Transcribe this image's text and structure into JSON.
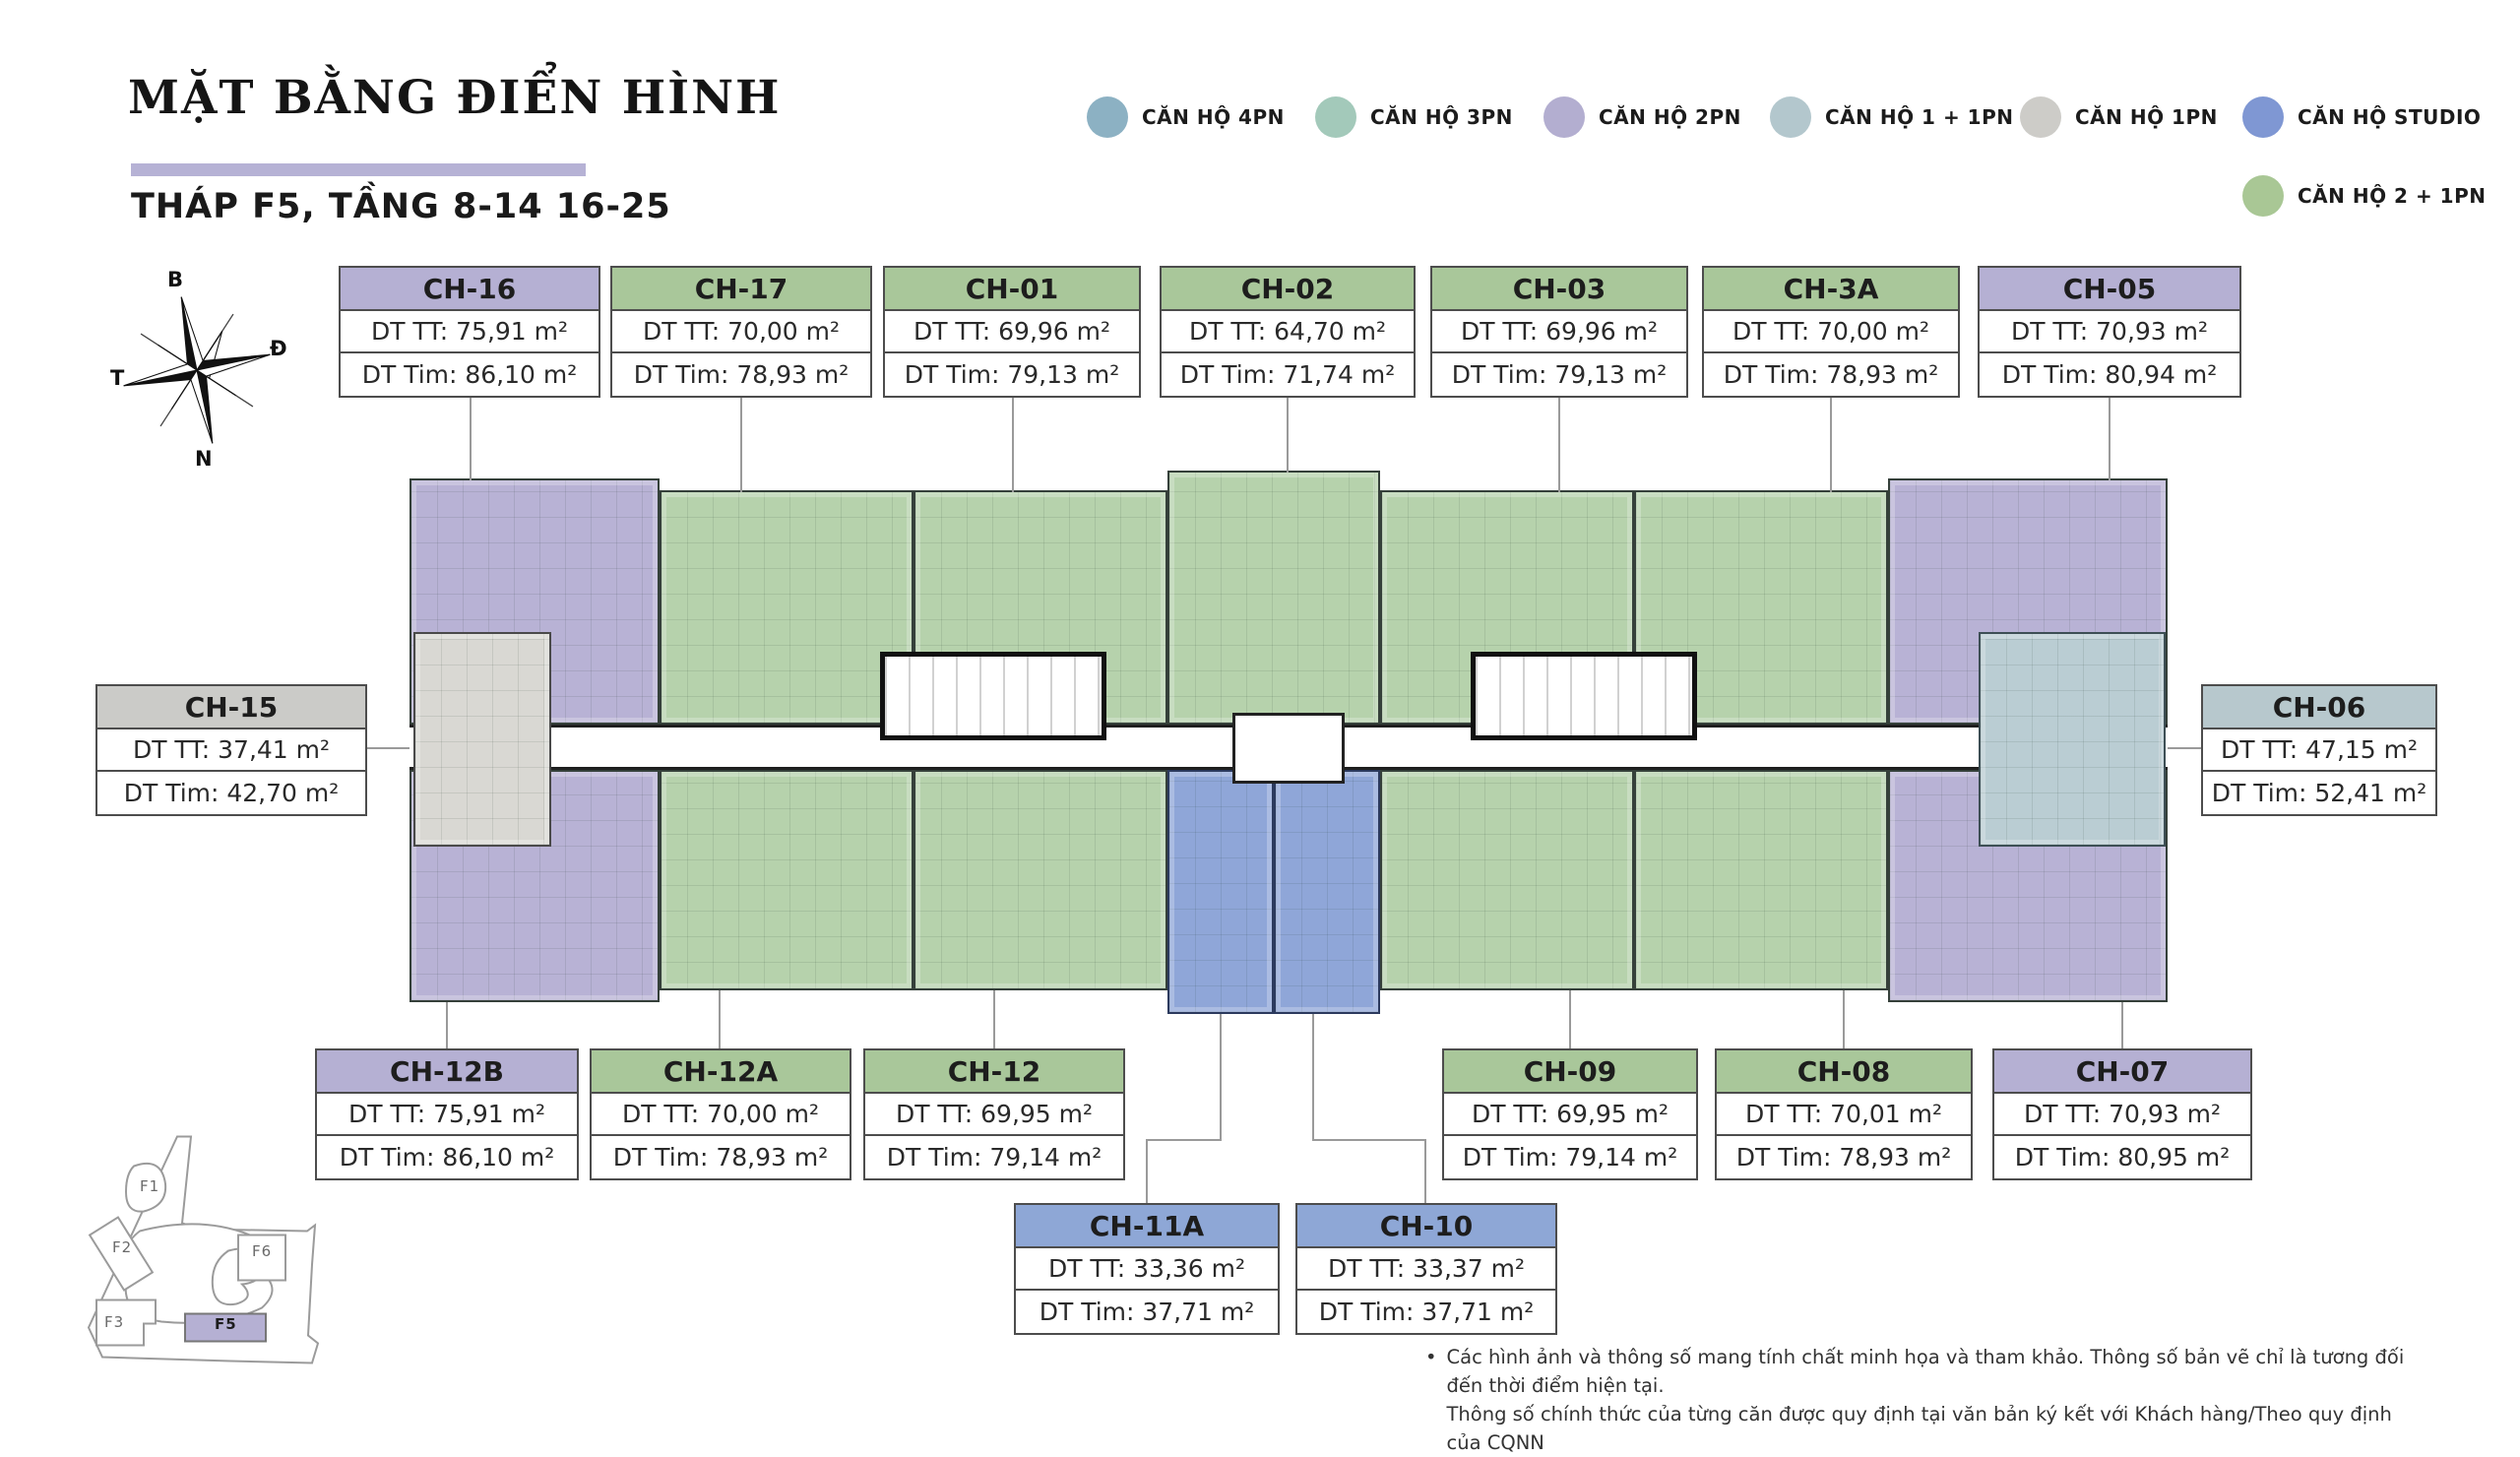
{
  "header": {
    "title": "MẶT BẰNG ĐIỂN HÌNH",
    "subtitle": "THÁP F5, TẦNG 8-14 16-25",
    "accent_bar_color": "#b6b2d5"
  },
  "legend": {
    "items": [
      {
        "label": "CĂN HỘ 4PN",
        "color": "#8cb1c3"
      },
      {
        "label": "CĂN HỘ 3PN",
        "color": "#a3c9ba"
      },
      {
        "label": "CĂN HỘ 2PN",
        "color": "#b3aed0"
      },
      {
        "label": "CĂN HỘ 1 + 1PN",
        "color": "#b3c7cd"
      },
      {
        "label": "CĂN HỘ 1PN",
        "color": "#cdccc8"
      },
      {
        "label": "CĂN HỘ STUDIO",
        "color": "#7f97d3"
      },
      {
        "label": "CĂN HỘ 2 + 1PN",
        "color": "#a9c795"
      }
    ]
  },
  "compass": {
    "north": "B",
    "east": "Đ",
    "west": "T",
    "south": "N"
  },
  "units": [
    {
      "code": "CH-16",
      "tt": "DT TT: 75,91 m²",
      "tim": "DT Tim: 86,10 m²",
      "type": "CĂN HỘ 2PN"
    },
    {
      "code": "CH-17",
      "tt": "DT TT: 70,00 m²",
      "tim": "DT Tim: 78,93 m²",
      "type": "CĂN HỘ 2 + 1PN"
    },
    {
      "code": "CH-01",
      "tt": "DT TT: 69,96 m²",
      "tim": "DT Tim: 79,13 m²",
      "type": "CĂN HỘ 2 + 1PN"
    },
    {
      "code": "CH-02",
      "tt": "DT TT: 64,70 m²",
      "tim": "DT Tim: 71,74 m²",
      "type": "CĂN HỘ 2 + 1PN"
    },
    {
      "code": "CH-03",
      "tt": "DT TT: 69,96 m²",
      "tim": "DT Tim: 79,13 m²",
      "type": "CĂN HỘ 2 + 1PN"
    },
    {
      "code": "CH-3A",
      "tt": "DT TT: 70,00 m²",
      "tim": "DT Tim: 78,93 m²",
      "type": "CĂN HỘ 2 + 1PN"
    },
    {
      "code": "CH-05",
      "tt": "DT TT: 70,93 m²",
      "tim": "DT Tim: 80,94 m²",
      "type": "CĂN HỘ 2PN"
    },
    {
      "code": "CH-15",
      "tt": "DT TT: 37,41 m²",
      "tim": "DT Tim: 42,70 m²",
      "type": "CĂN HỘ 1PN"
    },
    {
      "code": "CH-06",
      "tt": "DT TT: 47,15 m²",
      "tim": "DT Tim: 52,41 m²",
      "type": "CĂN HỘ 1 + 1PN"
    },
    {
      "code": "CH-12B",
      "tt": "DT TT: 75,91 m²",
      "tim": "DT Tim: 86,10 m²",
      "type": "CĂN HỘ 2PN"
    },
    {
      "code": "CH-12A",
      "tt": "DT TT: 70,00 m²",
      "tim": "DT Tim: 78,93 m²",
      "type": "CĂN HỘ 2 + 1PN"
    },
    {
      "code": "CH-12",
      "tt": "DT TT: 69,95 m²",
      "tim": "DT Tim: 79,14 m²",
      "type": "CĂN HỘ 2 + 1PN"
    },
    {
      "code": "CH-09",
      "tt": "DT TT: 69,95 m²",
      "tim": "DT Tim: 79,14 m²",
      "type": "CĂN HỘ 2 + 1PN"
    },
    {
      "code": "CH-08",
      "tt": "DT TT: 70,01 m²",
      "tim": "DT Tim: 78,93 m²",
      "type": "CĂN HỘ 2 + 1PN"
    },
    {
      "code": "CH-07",
      "tt": "DT TT: 70,93 m²",
      "tim": "DT Tim: 80,95 m²",
      "type": "CĂN HỘ 2PN"
    },
    {
      "code": "CH-11A",
      "tt": "DT TT: 33,36 m²",
      "tim": "DT Tim: 37,71 m²",
      "type": "CĂN HỘ STUDIO"
    },
    {
      "code": "CH-10",
      "tt": "DT TT: 33,37 m²",
      "tim": "DT Tim: 37,71 m²",
      "type": "CĂN HỘ STUDIO"
    }
  ],
  "site": {
    "plots": [
      {
        "id": "F1"
      },
      {
        "id": "F2"
      },
      {
        "id": "F3"
      },
      {
        "id": "F5"
      },
      {
        "id": "F6"
      }
    ],
    "highlighted": "F5",
    "highlight_color": "#b5b0d3"
  },
  "footnote": {
    "bullet": "•",
    "line1": "Các hình ảnh và thông số mang tính chất minh họa và tham khảo. Thông số bản vẽ chỉ là tương đối đến thời điểm hiện tại.",
    "line2": "Thông số chính thức của từng căn được quy định tại văn bản ký kết với Khách hàng/Theo quy định của CQNN"
  },
  "plan_colors": {
    "unit_green": "#b6d2ac",
    "unit_purple": "#b8b2d5",
    "unit_blue": "#8fa6d8",
    "unit_gray": "#d9d8d3",
    "unit_teal": "#bacdd3"
  }
}
